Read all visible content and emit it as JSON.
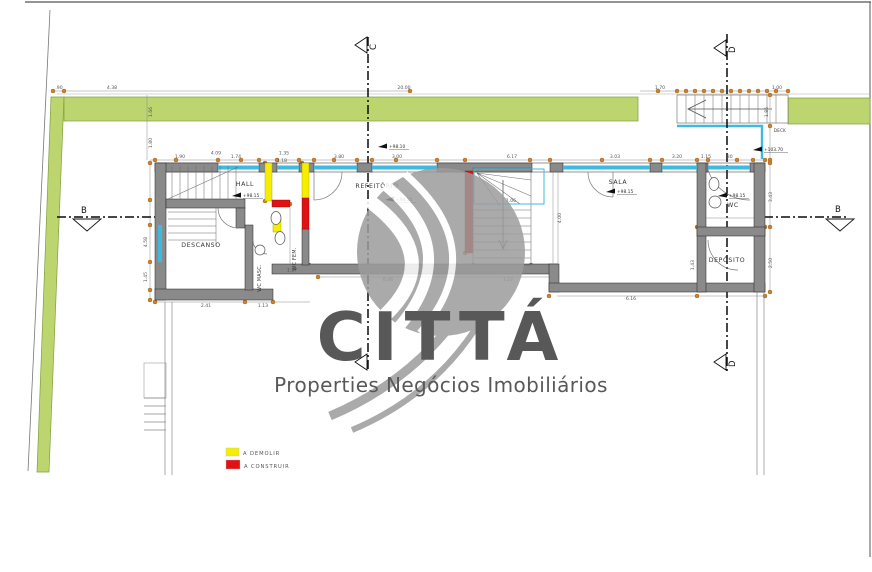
{
  "colors": {
    "green": "#bcd56e",
    "green_stroke": "#7f9e3f",
    "wall": "#8a8a8a",
    "window": "#3fb9dd",
    "demolish": "#f6ee00",
    "construct": "#e11212",
    "dimension": "#d2802a",
    "watermark": "#9c9c9c"
  },
  "watermark": {
    "brand": "CITTÁ",
    "tagline": "Properties Negócios Imobiliários"
  },
  "legend": {
    "demolish": "A DEMOLIR",
    "construct": "A CONSTRUIR"
  },
  "sections": {
    "b": "B",
    "c": "C",
    "d": "D"
  },
  "rooms": {
    "descanso": "DESCANSO",
    "hall": "HALL",
    "refeitorio": "REFEITÓRIO",
    "sala": "SALA",
    "wc": "WC",
    "deposito": "DEPÓSITO",
    "wc_masc": "WC MASC.",
    "wc_fem": "WC FEM.",
    "deck": "DECK"
  },
  "levels": {
    "hall": "+98.15",
    "front": "+98.10",
    "refeitorio": "+98.15",
    "sala": "+98.15",
    "wc": "+98.15",
    "deck": "+103.70"
  },
  "dims": [
    ".90",
    "4.38",
    "20.00",
    "1.70",
    "1.00",
    "1.90",
    "4.09",
    "1.74",
    "1.35",
    "1.18",
    "3.80",
    "3.00",
    "6.17",
    "3.03",
    "3.20",
    "1.15",
    ".80",
    "2.41",
    "1.13",
    "1.37",
    "6.46",
    "3.27",
    "6.16",
    "1.66",
    "1.80",
    "4.58",
    "1.45",
    "3.43",
    "2.50",
    "1.43",
    "1.85",
    "4.00",
    "1.06"
  ]
}
